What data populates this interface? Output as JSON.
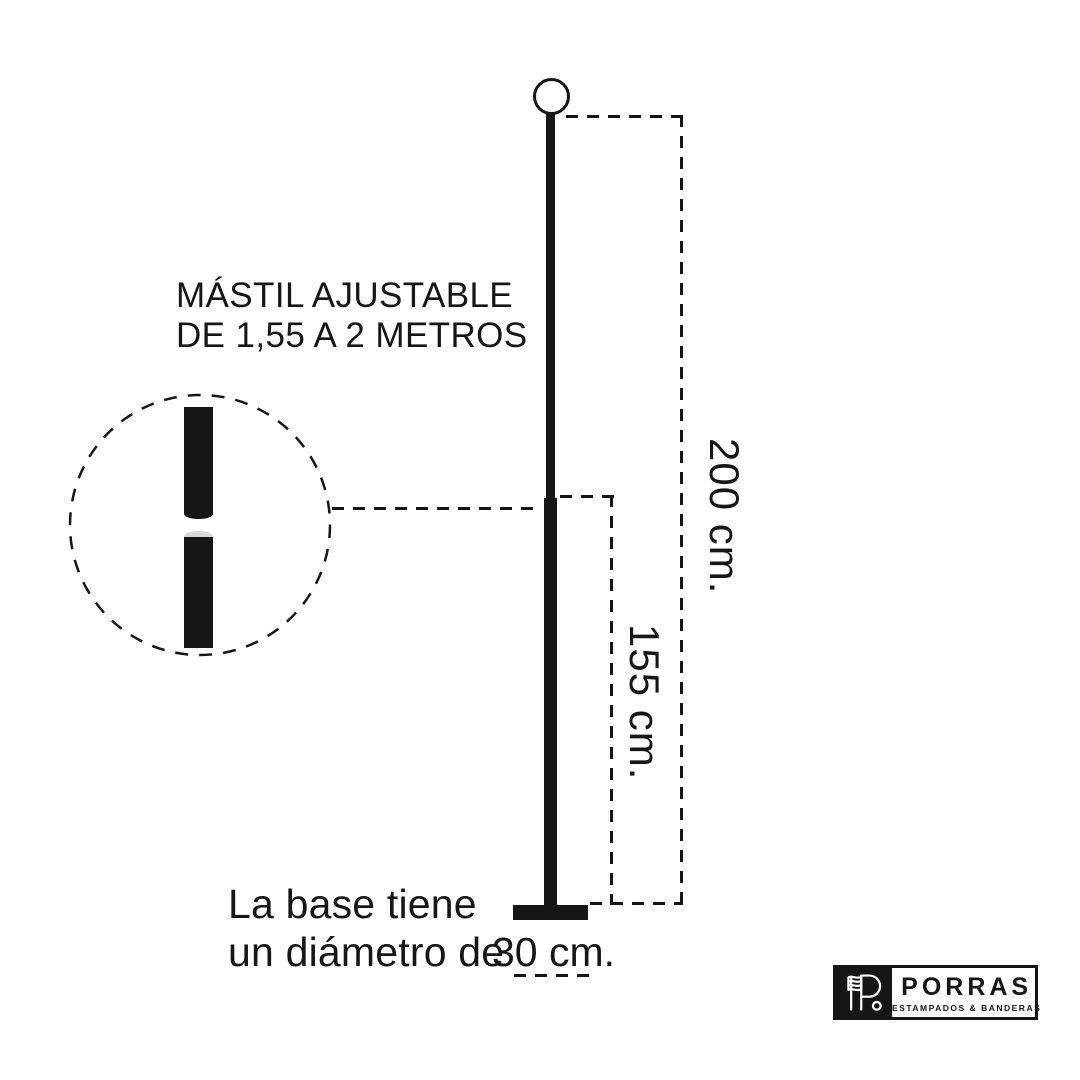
{
  "mast_label": {
    "line1": "MÁSTIL AJUSTABLE",
    "line2": "DE 1,55 A 2 METROS"
  },
  "dimension_labels": {
    "full_height": "200 cm.",
    "min_height": "155 cm.",
    "base_diameter": "30 cm."
  },
  "base_caption": {
    "line1": "La base tiene",
    "line2": "un diámetro de"
  },
  "brand": {
    "name": "PORRAS",
    "tagline": "ESTAMPADOS & BANDERAS"
  },
  "colors": {
    "ink": "#161616",
    "bg": "#ffffff",
    "cylinder_top": "#d9d9d9"
  }
}
